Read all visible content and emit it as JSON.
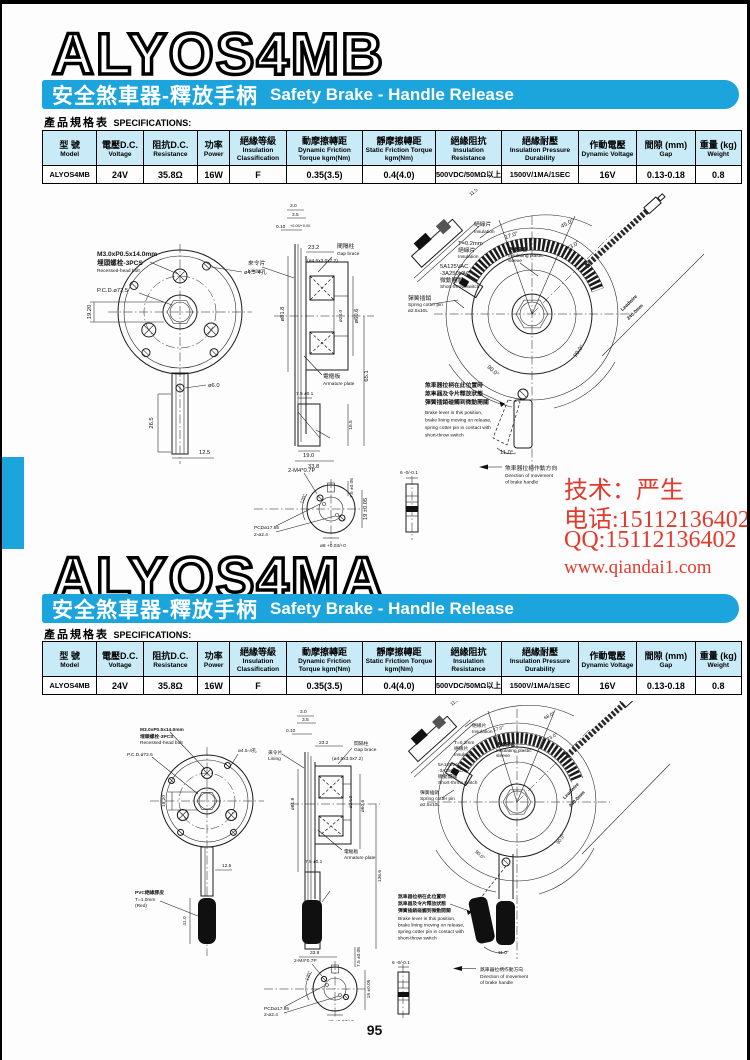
{
  "page": {
    "number": "95"
  },
  "colors": {
    "banner": "#1ca4dc",
    "table_header": "#c9ebf8",
    "watermark": "#e23b2e"
  },
  "banner": {
    "zh": "安全煞車器-釋放手柄",
    "en": "Safety Brake - Handle Release"
  },
  "specs_label": {
    "zh": "產品規格表",
    "en": "SPECIFICATIONS:"
  },
  "sections": [
    {
      "title": "ALYOS4MB"
    },
    {
      "title": "ALYOS4MA"
    }
  ],
  "spec_table": {
    "headers": [
      {
        "zh": "型 號",
        "en": "Model"
      },
      {
        "zh": "電壓D.C.",
        "en": "Voltage"
      },
      {
        "zh": "阻抗D.C.",
        "en": "Resistance"
      },
      {
        "zh": "功率",
        "en": "Power"
      },
      {
        "zh": "絕緣等級",
        "en": "Insulation Classification"
      },
      {
        "zh": "動摩擦轉距",
        "en": "Dynamic Friction Torque kgm(Nm)"
      },
      {
        "zh": "靜摩擦轉距",
        "en": "Static Friction Torque kgm(Nm)"
      },
      {
        "zh": "絕緣阻抗",
        "en": "Insulation Resistance"
      },
      {
        "zh": "絕緣耐壓",
        "en": "Insulation Pressure Durability"
      },
      {
        "zh": "作動電壓",
        "en": "Dynamic Voltage"
      },
      {
        "zh": "間隙 (mm)",
        "en": "Gap"
      },
      {
        "zh": "重量 (kg)",
        "en": "Weight"
      }
    ],
    "row": [
      "ALYOS4MB",
      "24V",
      "35.8Ω",
      "16W",
      "F",
      "0.35(3.5)",
      "0.4(4.0)",
      "500VDC/50MΩ以上",
      "1500V/1MA/1SEC",
      "16V",
      "0.13-0.18",
      "0.8"
    ]
  },
  "watermark": {
    "line1": "技术：严生",
    "line2": "电话:15112136402",
    "line3": "QQ:15112136402",
    "line4": "www.qiandai1.com"
  },
  "dwg": {
    "bolt_spec": "M3.0xP0.5x14.0mm",
    "bolt_zh": "埋頭螺栓-3PCS",
    "bolt_en": "Recessed-head bolt",
    "pcd": "P.C.D.ø72.5",
    "holes": "ø4.5-4孔",
    "dim_19_20": "19.20",
    "dim_12_5": "12.5",
    "dim_3_0": "3.0",
    "dim_3_5": "3.5",
    "dim_0_10": "0.10",
    "tol_010": "+0.05/+0.00",
    "dim_23_2": "23.2",
    "gap_zh": "間隔柱",
    "gap_en": "Gap brace",
    "gap_size": "(ø4.5x3.0x7.2)",
    "lining_zh": "來令片",
    "lining_en": "Lining",
    "dia_81_8": "ø81.8",
    "dia_24_0": "ø24.0",
    "dia_60_6": "ø60.6",
    "armature_zh": "電樞板",
    "armature_en": "Armature plate",
    "dim_7_5": "7.5 ±0.1",
    "dim_33_8": "33.8",
    "insul_zh": "絕緣片",
    "insul_en": "Insulation",
    "t02": "T=0.2mm",
    "sw_v1": "5A125VAC",
    "sw_v2": "-3A250VAC",
    "sw_zh": "微動開關",
    "sw_en": "Short-throw switch",
    "pin_zh": "彈簧插銷",
    "pin_en": "Spring cotter pin",
    "pin_size": "ø2.5x10L",
    "sleeve_zh": "絕緣膠套",
    "sleeve_en1": "Insulating plastic",
    "sleeve_en2": "sleeve",
    "ang_17": "17.0°",
    "ang_73": "73.0°",
    "ang_90": "90.0°",
    "ang_11": "11.0°",
    "dim_11_5": "11.5",
    "lead1": "Leadwire",
    "lead2": "240.0mm",
    "pos_zh1": "煞車器拉柄在此位置時",
    "pos_zh2": "煞車器及令片釋放狀態",
    "pos_zh3": "彈簧插銷碰觸到微動開關",
    "pos_en1": "Brake lever in this position,",
    "pos_en2": "brake lining moving on release,",
    "pos_en3": "spring cotter pin in contact with",
    "pos_en4": "short-throw switch",
    "dir_zh": "煞車器拉柄作動方向",
    "dir_en1": "Direction of movement",
    "dir_en2": "of brake handle",
    "hub_bolt": "2-M4*0.7P",
    "ang_120": "120°",
    "hub_pcd": "PCDø17.85",
    "hub_holes": "2-ø2.4",
    "dim_7_5b": "7.5 ±0.05",
    "dim_19b": "19 ±0.05",
    "dia_8": "ø8 +0.03/+0",
    "dim_6": "6 -0/-0.1"
  },
  "s1": {
    "dia_6": "ø6.0",
    "dim_26_5": "26.5",
    "dim_65_1": "65.1",
    "dim_16_5": "16.5",
    "dim_19_0": "19.0",
    "ang_45": "45.0°"
  },
  "s2": {
    "dim_41": "41.0",
    "dim_136_6": "136.6",
    "ang_68": "68.0°",
    "pvc1": "PVC絕緣膠皮",
    "pvc2": "T=1.0mm",
    "pvc3": "(Red)"
  }
}
